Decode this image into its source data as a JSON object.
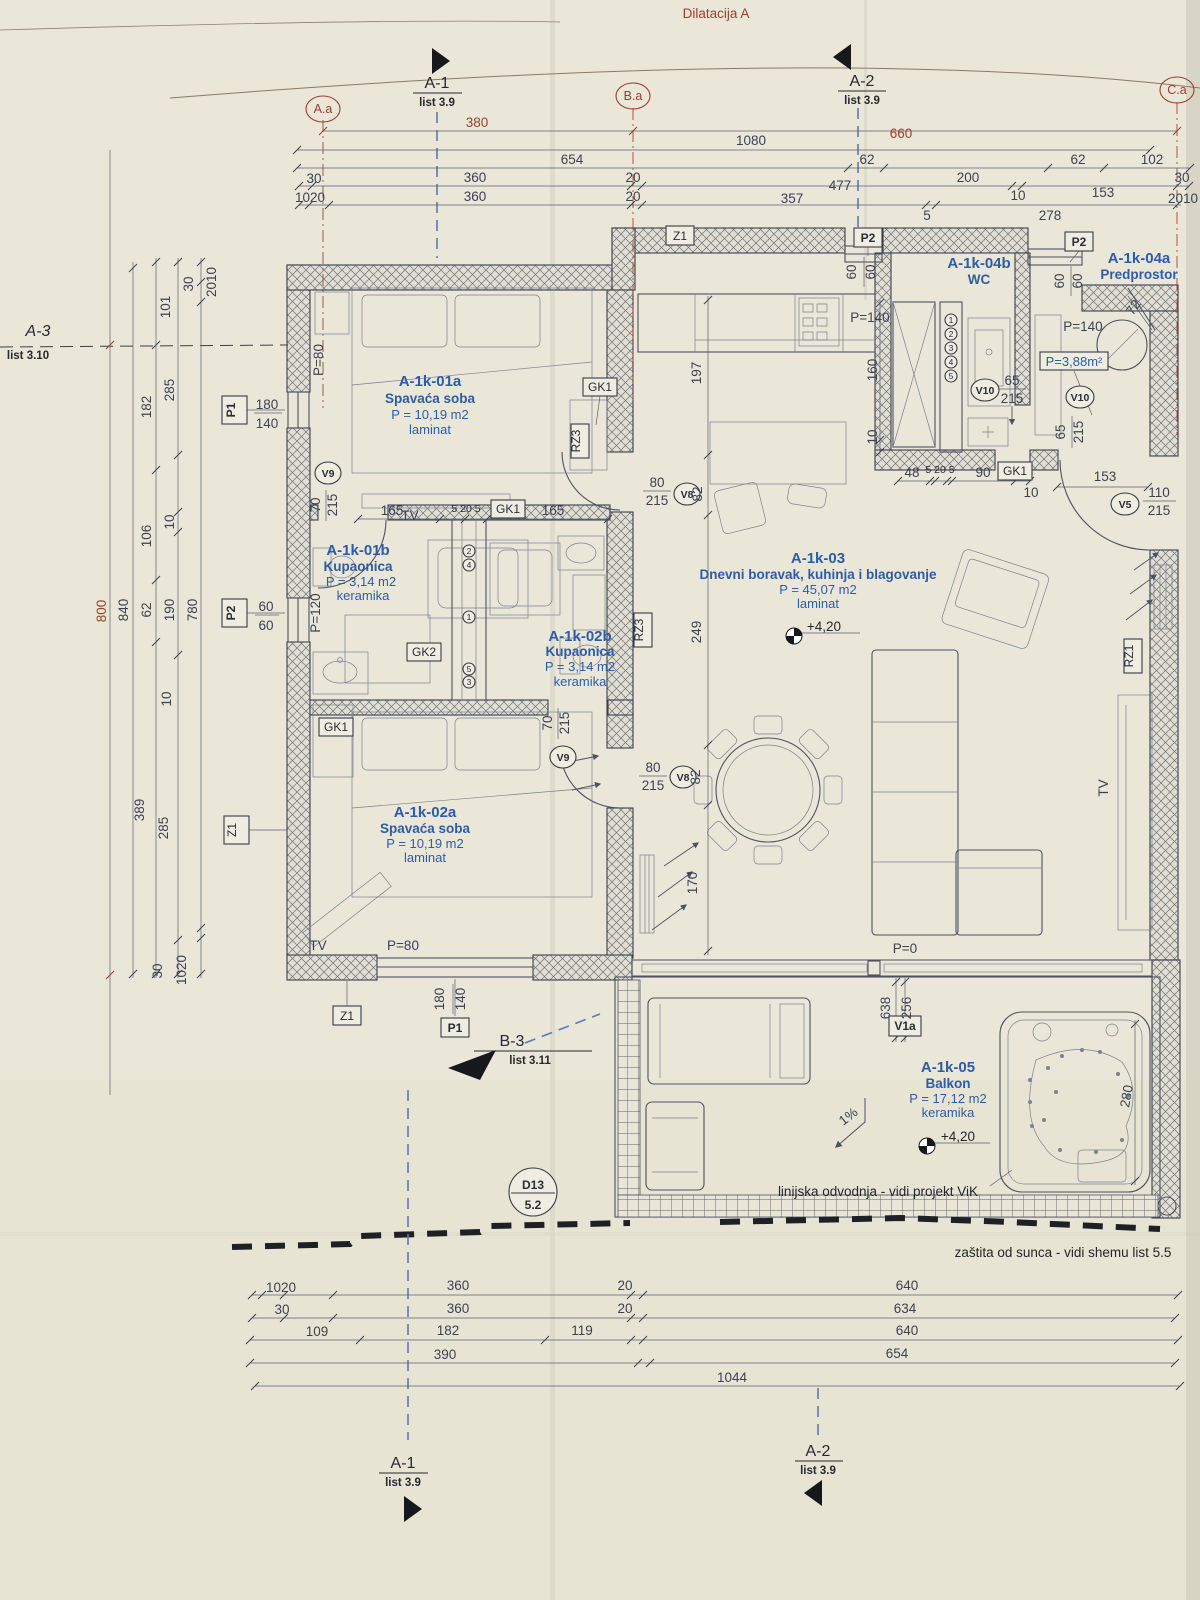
{
  "sheet": {
    "title": "Dilatacija A"
  },
  "axes": {
    "aa": "A.a",
    "ba": "B.a",
    "ca": "C.a"
  },
  "sections": {
    "a1_top": {
      "name": "A-1",
      "sheet": "list 3.9"
    },
    "a2_top": {
      "name": "A-2",
      "sheet": "list 3.9"
    },
    "a1_bottom": {
      "name": "A-1",
      "sheet": "list 3.9"
    },
    "a2_bottom": {
      "name": "A-2",
      "sheet": "list 3.9"
    },
    "a3_left": {
      "name": "A-3",
      "sheet": "list 3.10"
    },
    "b3": {
      "name": "B-3",
      "sheet": "list 3.11"
    },
    "d13": {
      "name": "D13",
      "sheet": "5.2"
    }
  },
  "rooms": {
    "r01a": {
      "id": "A-1k-01a",
      "name": "Spavaća soba",
      "area": "P = 10,19 m2",
      "floor": "laminat"
    },
    "r01b": {
      "id": "A-1k-01b",
      "name": "Kupaonica",
      "area": "P = 3,14 m2",
      "floor": "keramika"
    },
    "r02b": {
      "id": "A-1k-02b",
      "name": "Kupaonica",
      "area": "P = 3,14 m2",
      "floor": "keramika"
    },
    "r02a": {
      "id": "A-1k-02a",
      "name": "Spavaća soba",
      "area": "P = 10,19 m2",
      "floor": "laminat"
    },
    "r03": {
      "id": "A-1k-03",
      "name": "Dnevni boravak, kuhinja i blagovanje",
      "area": "P = 45,07 m2",
      "floor": "laminat"
    },
    "r04b": {
      "id": "A-1k-04b",
      "name": "WC"
    },
    "r04a": {
      "id": "A-1k-04a",
      "name": "Predprostor",
      "area": "P=3,88m²"
    },
    "r05": {
      "id": "A-1k-05",
      "name": "Balkon",
      "area": "P = 17,12 m2",
      "floor": "keramika"
    }
  },
  "levels": {
    "living": "+4,20",
    "balcony": "+4,20"
  },
  "notes": {
    "drainage": "linijska odvodnja - vidi projekt ViK",
    "sun": "zaštita od sunca - vidi shemu list 5.5",
    "slope": "1%"
  },
  "doors": {
    "v9a": {
      "tag": "V9",
      "w": "70",
      "h": "215"
    },
    "v9b": {
      "tag": "V9",
      "w": "70",
      "h": "215"
    },
    "v8a": {
      "tag": "V8",
      "w": "80",
      "h": "215"
    },
    "v8b": {
      "tag": "V8",
      "w": "80",
      "h": "215"
    },
    "v10a": {
      "tag": "V10",
      "w": "65",
      "h": "215"
    },
    "v10b": {
      "tag": "V10",
      "w": "65",
      "h": "215"
    },
    "v5": {
      "tag": "V5",
      "w": "110",
      "h": "215"
    },
    "v1a": {
      "tag": "V1a"
    }
  },
  "windows": {
    "p1_left": {
      "tag": "P1",
      "w": "180",
      "h": "140"
    },
    "p2_left": {
      "tag": "P2",
      "w": "60",
      "h": "60"
    },
    "p2_top1": {
      "tag": "P2",
      "w": "60",
      "h": "60"
    },
    "p2_top2": {
      "tag": "P2",
      "w": "60",
      "h": "60"
    },
    "p1_bottom": {
      "tag": "P1",
      "w": "180",
      "h": "140"
    }
  },
  "parapets": {
    "p80a": "P=80",
    "p80b": "P=80",
    "p120": "P=120",
    "p140a": "P=140",
    "p140b": "P=140",
    "p0": "P=0"
  },
  "tags": {
    "z1a": "Z1",
    "z1b": "Z1",
    "z1c": "Z1",
    "gk1a": "GK1",
    "gk1b": "GK1",
    "gk1c": "GK1",
    "gk1d": "GK1",
    "gk2": "GK2",
    "rz3a": "RZ3",
    "rz3b": "RZ3",
    "rz1": "RZ1",
    "tv1": "TV",
    "tv2": "TV",
    "tv3": "TV"
  },
  "shaft_wc": [
    "1",
    "2",
    "3",
    "4",
    "5"
  ],
  "shaft_bath": [
    "2",
    "4",
    "1",
    "5",
    "3"
  ],
  "dims": {
    "top": [
      "380",
      "1080",
      "660",
      "654",
      "62",
      "200",
      "62",
      "102",
      "30",
      "360",
      "20",
      "477",
      "153",
      "30",
      "1020",
      "360",
      "20",
      "357",
      "5",
      "10",
      "278",
      "2010"
    ],
    "left": [
      "101",
      "30",
      "2010",
      "285",
      "182",
      "106",
      "10",
      "800",
      "840",
      "62",
      "190",
      "780",
      "10",
      "389",
      "285",
      "30",
      "1020"
    ],
    "bottom": [
      "1020",
      "30",
      "109",
      "360",
      "360",
      "182",
      "390",
      "119",
      "20",
      "20",
      "640",
      "634",
      "640",
      "654",
      "1044"
    ],
    "inner": [
      "197",
      "160",
      "10",
      "48",
      "5 20 5",
      "90",
      "10",
      "153",
      "165",
      "5 20 5",
      "165",
      "82",
      "249",
      "82",
      "170",
      "638",
      "256",
      "280",
      "72"
    ]
  }
}
